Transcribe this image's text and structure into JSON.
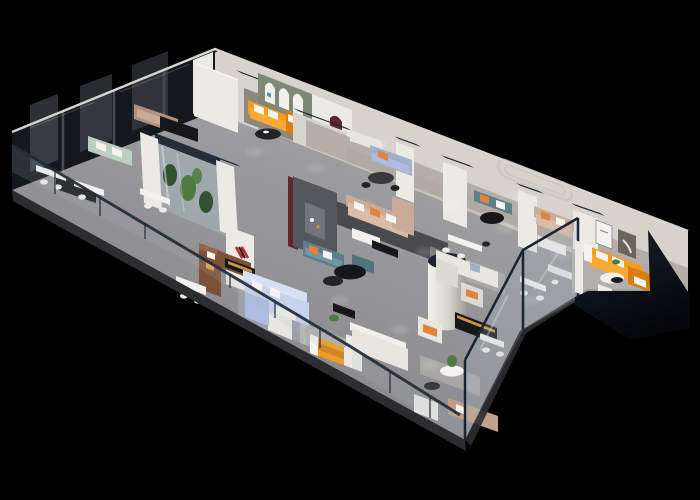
{
  "scene": {
    "description": "Isometric 3D cutaway rendering of a furniture showroom floor plan on a black background",
    "background": "#000000"
  },
  "colors": {
    "background": "#000000",
    "floorLight": "#abaaac",
    "floorDark": "#838286",
    "roofline": "#d8d5cf",
    "backWall": "#d7d3cc",
    "backWallShadow": "#b7b3ab",
    "aisle": "#a8a29a",
    "roomFloorDark": "#6e6b6d",
    "roomFloorWarm": "#8b8781",
    "marble": "#b7b3ae",
    "glassDark": "#14171c",
    "glassFrame": "#454c54",
    "glassHint": "#59626a",
    "wallWhite": "#eceae4",
    "wallShade": "#d7d4cc",
    "wallTopLight": "#f4f2ee",
    "capNavy": "#1a2432",
    "archWall": "#7e8a76",
    "archWhite": "#f1f0ec",
    "logoBlue": "#4a9ab8",
    "maroon": "#5f2630",
    "partGray": "#54575b",
    "partGrayLight": "#71747a",
    "logoRed": "#c1252e",
    "logoBlack": "#1c1c1e",
    "orange": "#f39c1e",
    "orangeShade": "#d97f10",
    "orangeHi": "#f7ab33",
    "blueSofa": "#c7d2ec",
    "blueSofaShade": "#aebce0",
    "blueSofaLight": "#d8e0f4",
    "teal": "#5c7f8a",
    "tealLight": "#7695a0",
    "tealOttoman": "#4e747e",
    "tan": "#c9ab97",
    "tanLight": "#d8bca7",
    "tanDark": "#b29079",
    "tanBottom": "#c2a089",
    "mint": "#bccfc0",
    "brown": "#7d5138",
    "brownHi": "#94664a",
    "redBench": "#9c4632",
    "whiteSofa": "#e8e6e1",
    "whiteSofaHi": "#f2f0ec",
    "graySofa": "#dcdad5",
    "pillowWhite": "#f6f4f0",
    "pillowOrange": "#e0833c",
    "pillowYellow": "#e8a33c",
    "pillowBlue": "#9fb0c8",
    "tableBlack": "#17171a",
    "tableCharcoal": "#38383d",
    "tableWhite": "#f2f1ee",
    "chairDark": "#232327",
    "chairWhite": "#eeedea",
    "rugDark": "#3b3c3f",
    "rugLight": "#cfcbc2",
    "rugBlue": "#a9b2c4",
    "plantGreen": "#4e7a42",
    "plantDark": "#33512e",
    "terrGlass": "#a7bcc0",
    "glassStreak": "#dfe8ea",
    "balGlass": "#a9bcc2",
    "railDark": "#222b35",
    "slabEdge": "#2d2d30",
    "wedgeTop": "#1a2230",
    "wedgeBottom": "#04060a",
    "gold": "#cf943b",
    "artDark": "#6b6459",
    "artLine": "#8a8780",
    "decor": "#c6c3bc",
    "cylShade": "#a09d97",
    "spot": "#ffffff"
  }
}
